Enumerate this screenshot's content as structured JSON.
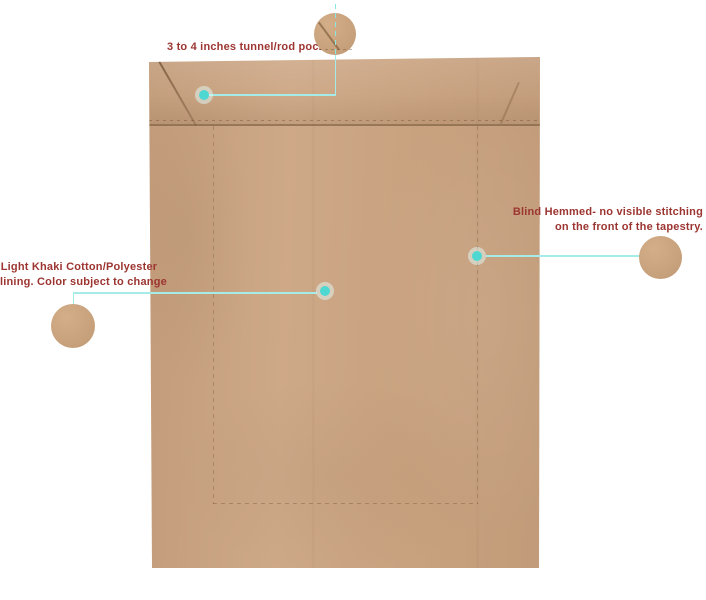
{
  "canvas": {
    "width": 706,
    "height": 600,
    "background": "#ffffff"
  },
  "subject": {
    "description": "back of khaki tapestry lining panel with annotated construction details",
    "fabric_color": "#cba481"
  },
  "annotations": {
    "rod_pocket": {
      "label": "3 to 4 inches tunnel/rod pocket."
    },
    "lining": {
      "line1": "Light Khaki Cotton/Polyester",
      "line2": "lining. Color subject to change"
    },
    "blind_hem": {
      "line1": "Blind Hemmed- no visible stitching",
      "line2": "on the front of the tapestry."
    }
  },
  "colors": {
    "annotation_text": "#9c3531",
    "connector_line": "#a5ebe8",
    "marker_dot": "#4fd8d2",
    "fabric_base": "#cba481",
    "seam_line": "#765636"
  }
}
